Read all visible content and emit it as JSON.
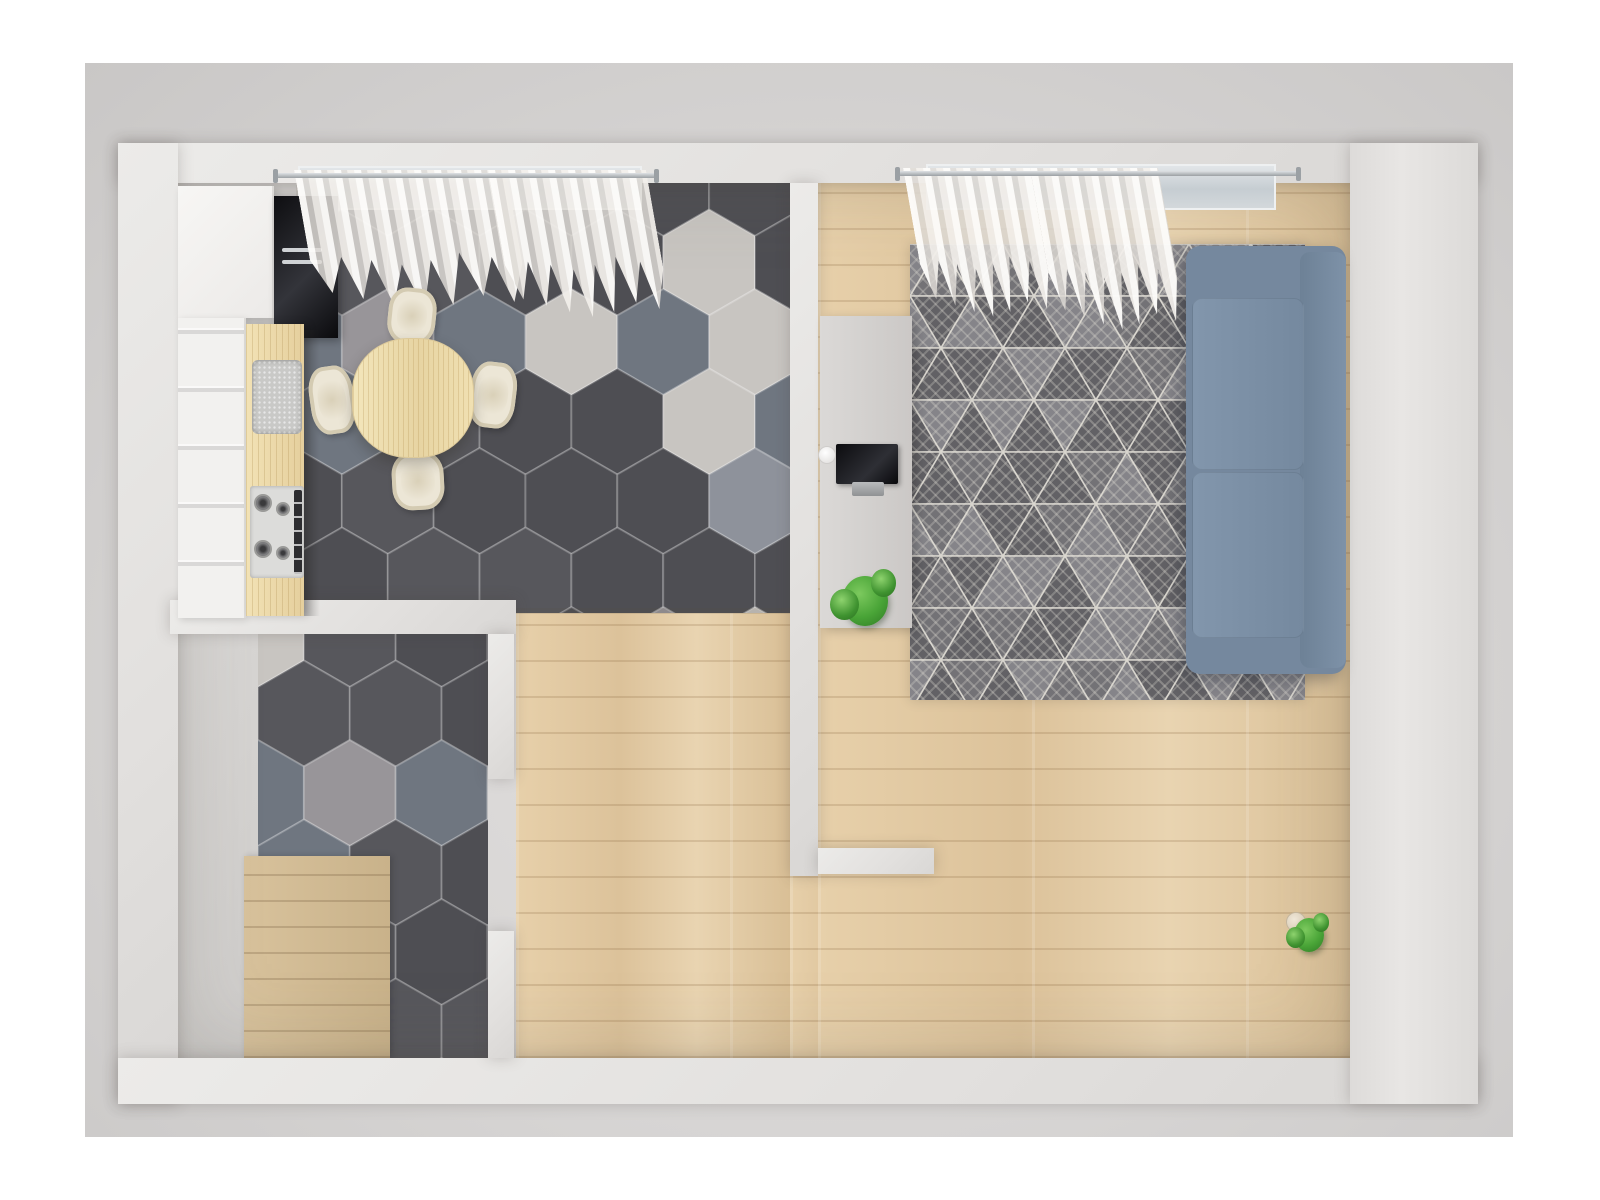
{
  "scene": {
    "type": "floor-plan-3d-render",
    "view": "top-down",
    "description": "Top-down 3D render of a one-bedroom apartment: kitchen-dining room with hexagon tile floor, living room with sofa and rug, bathroom with shower, and entry hallway.",
    "rooms": [
      {
        "name": "kitchen-dining",
        "items": [
          "tall cabinet",
          "built-in oven",
          "base cabinets",
          "wood countertop",
          "sink",
          "gas hob",
          "oval dining table",
          "four cream chairs",
          "window with two sheer curtains",
          "hexagon tile floor"
        ]
      },
      {
        "name": "living-room",
        "items": [
          "blue sofa",
          "plaid blanket",
          "three patterned pillows",
          "geometric gray rug",
          "media console",
          "tv",
          "round speaker",
          "potted plant",
          "pendant lamp",
          "window with two sheer curtains",
          "three green wall artworks",
          "white desk",
          "desk lamp",
          "papers",
          "desk plant",
          "white shell chair",
          "wood plank floor"
        ]
      },
      {
        "name": "bathroom",
        "items": [
          "toilet",
          "washbasin with faucet",
          "shower area with wood floor",
          "glass shower screen",
          "shower head",
          "chrome towel rails",
          "white slatted bench",
          "hexagon tile floor"
        ]
      },
      {
        "name": "hallway",
        "items": [
          "entry door",
          "multicolor striped doormat",
          "wood-front wardrobe",
          "white closet",
          "open door to bathroom",
          "open door to living room",
          "wood plank floor"
        ]
      }
    ]
  },
  "palette": {
    "page_bg": "#ffffff",
    "ground": "#d6d4d3",
    "wall": "#e2e0de",
    "wood_floor": "#e0c9a3",
    "shower_wood": "#d2bc95",
    "counter_wood": "#edd9a9",
    "table_wood": "#eedfb2",
    "chair_cream": "#ece6d6",
    "sofa_blue": "#7b8fa5",
    "rug_dark": "#636266",
    "tv_black": "#1b1b1e",
    "plant_green": "#49a437",
    "curtain_white": "#f4f1ed",
    "glass_blue": "#c6cdd2",
    "chrome": "#c3c6c9",
    "door_gray": "#d6d4d2",
    "wardrobe_wood": "#e6d5b8",
    "closet_white": "#f7f6f5"
  },
  "floor_tiles": {
    "colors": [
      "#4e4e53",
      "#57575c",
      "#6f7680",
      "#989599",
      "#c8c5c1",
      "#8e929b"
    ],
    "weights": [
      6,
      4,
      2,
      2,
      2,
      1
    ],
    "grout": "rgba(250,250,250,0.22)"
  },
  "rug": {
    "base": "#626165",
    "mid": "#737276",
    "light": "#858489",
    "line": "#d7d4cd"
  },
  "doormat": {
    "colors": [
      "#2b2340",
      "#c22a6e",
      "#e8b63a",
      "#efe7e2",
      "#8c1f3f",
      "#1c1b2e",
      "#d8447c",
      "#f2f0ee",
      "#c93a2e",
      "#273a77",
      "#efc23b",
      "#171423",
      "#b5326b",
      "#ece8e4",
      "#8c2340",
      "#2c2a44",
      "#d8447c",
      "#efc23b",
      "#1c1b2e",
      "#c93a2e",
      "#efe7e2",
      "#273a77"
    ]
  },
  "art_frames": [
    {
      "c1": "#0a2e1f",
      "c2": "#1d7a4e",
      "c3": "#0c3a26"
    },
    {
      "c1": "#0d4027",
      "c2": "#2c9a63",
      "c3": "#11512f"
    },
    {
      "c1": "#0b3322",
      "c2": "#23865a",
      "c3": "#0d3d27"
    }
  ],
  "labels": {
    "plan": "Top-down 3D apartment floor plan render",
    "kitchen": "Kitchen and dining area with hexagon tile floor",
    "living": "Living room with wood plank floor",
    "bathroom": "Bathroom with shower area",
    "hallway": "Entry hallway",
    "sofa": "Blue three-seat sofa",
    "rug": "Gray geometric area rug",
    "tv": "TV on media console",
    "console": "Media console",
    "dining_table": "Oval wooden dining table",
    "chair": "Dining chair",
    "oven": "Built-in oven",
    "hob": "Gas hob",
    "sink": "Kitchen sink",
    "counter": "Wooden countertop",
    "toilet": "Toilet",
    "washbasin": "Washbasin",
    "shower": "Walk-in shower with wood floor",
    "bench": "Slatted bathroom bench",
    "wardrobe": "Wood-front wardrobe",
    "closet": "White closet",
    "doormat": "Multicolor striped doormat",
    "entry_door": "Entry door",
    "desk": "White desk",
    "desk_chair": "White shell chair",
    "pendant_lamp": "Pendant lamp",
    "curtain": "Sheer curtain",
    "window": "Window",
    "artwork": "Green botanical artwork",
    "blanket": "Plaid blanket",
    "pillow": "Decorative pillow",
    "plant": "Potted plant",
    "door_leaf": "Open interior door"
  }
}
